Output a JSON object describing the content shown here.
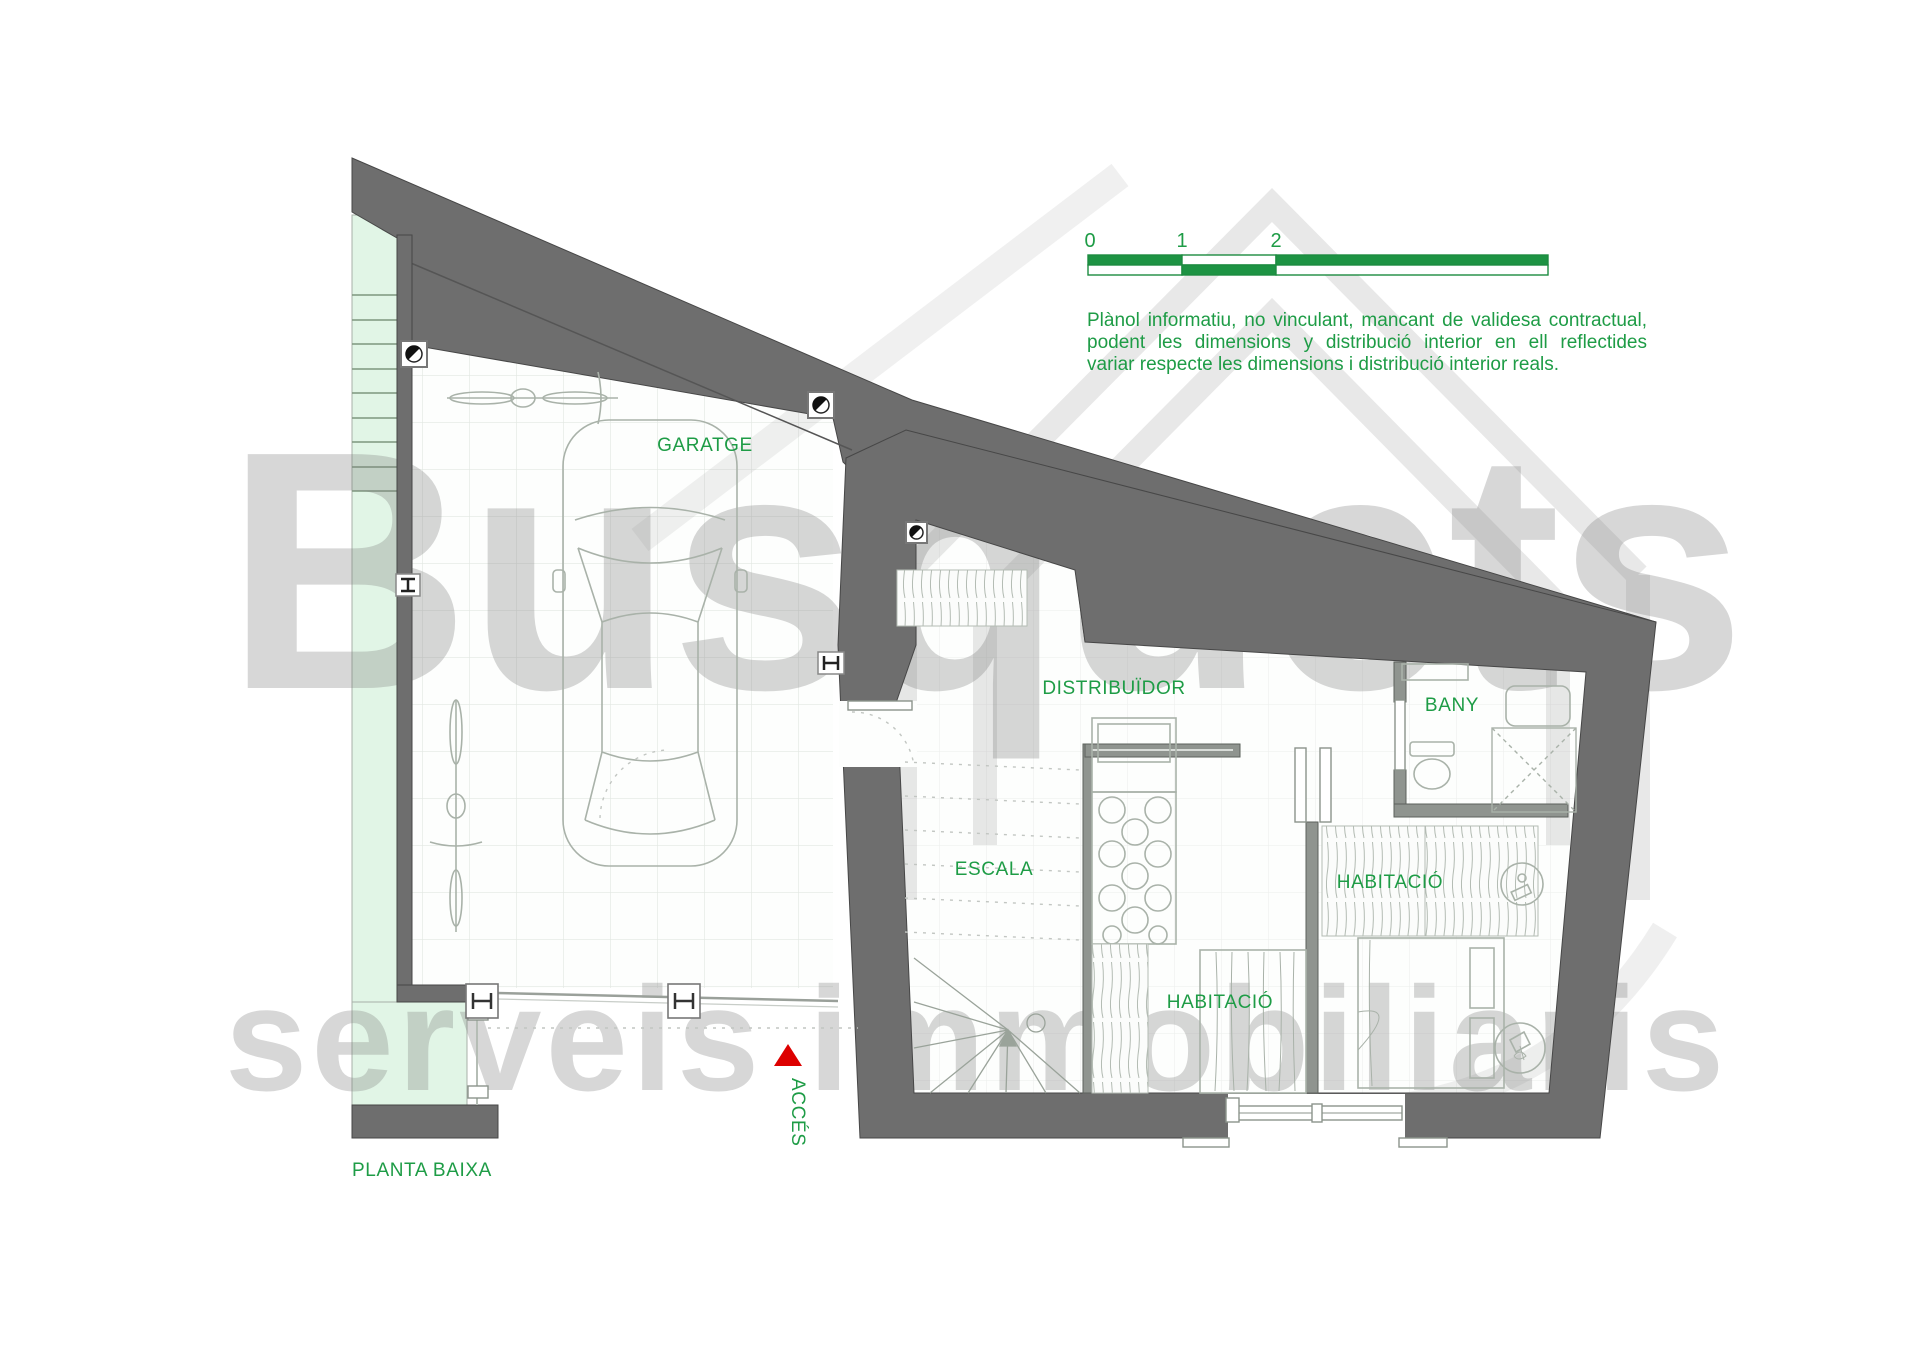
{
  "plan": {
    "floor_label": "PLANTA BAIXA",
    "rooms": {
      "garatge": "GARATGE",
      "distribuidor": "DISTRIBUÏDOR",
      "escala": "ESCALA",
      "bany": "BANY",
      "habitacio_right": "HABITACIÓ",
      "habitacio_bottom": "HABITACIÓ",
      "acces": "ACCÉS"
    }
  },
  "scale_bar": {
    "ticks": [
      "0",
      "1",
      "2",
      "5"
    ]
  },
  "disclaimer": {
    "line1": "Plànol informatiu, no vinculant, mancant de validesa contractual,",
    "line2": "podent les dimensions y distribució interior en ell reflectides",
    "line3": "variar respecte les dimensions i distribució interior reals."
  },
  "watermark": {
    "brand": "Busquets",
    "tagline": "serveis  immobiliaris"
  },
  "colors": {
    "label_green": "#1e9c46",
    "scale_green": "#1d9343",
    "wall_gray": "#6e6e6e",
    "terrace_green": "#e1f5e6",
    "accent_red": "#dd0000"
  }
}
